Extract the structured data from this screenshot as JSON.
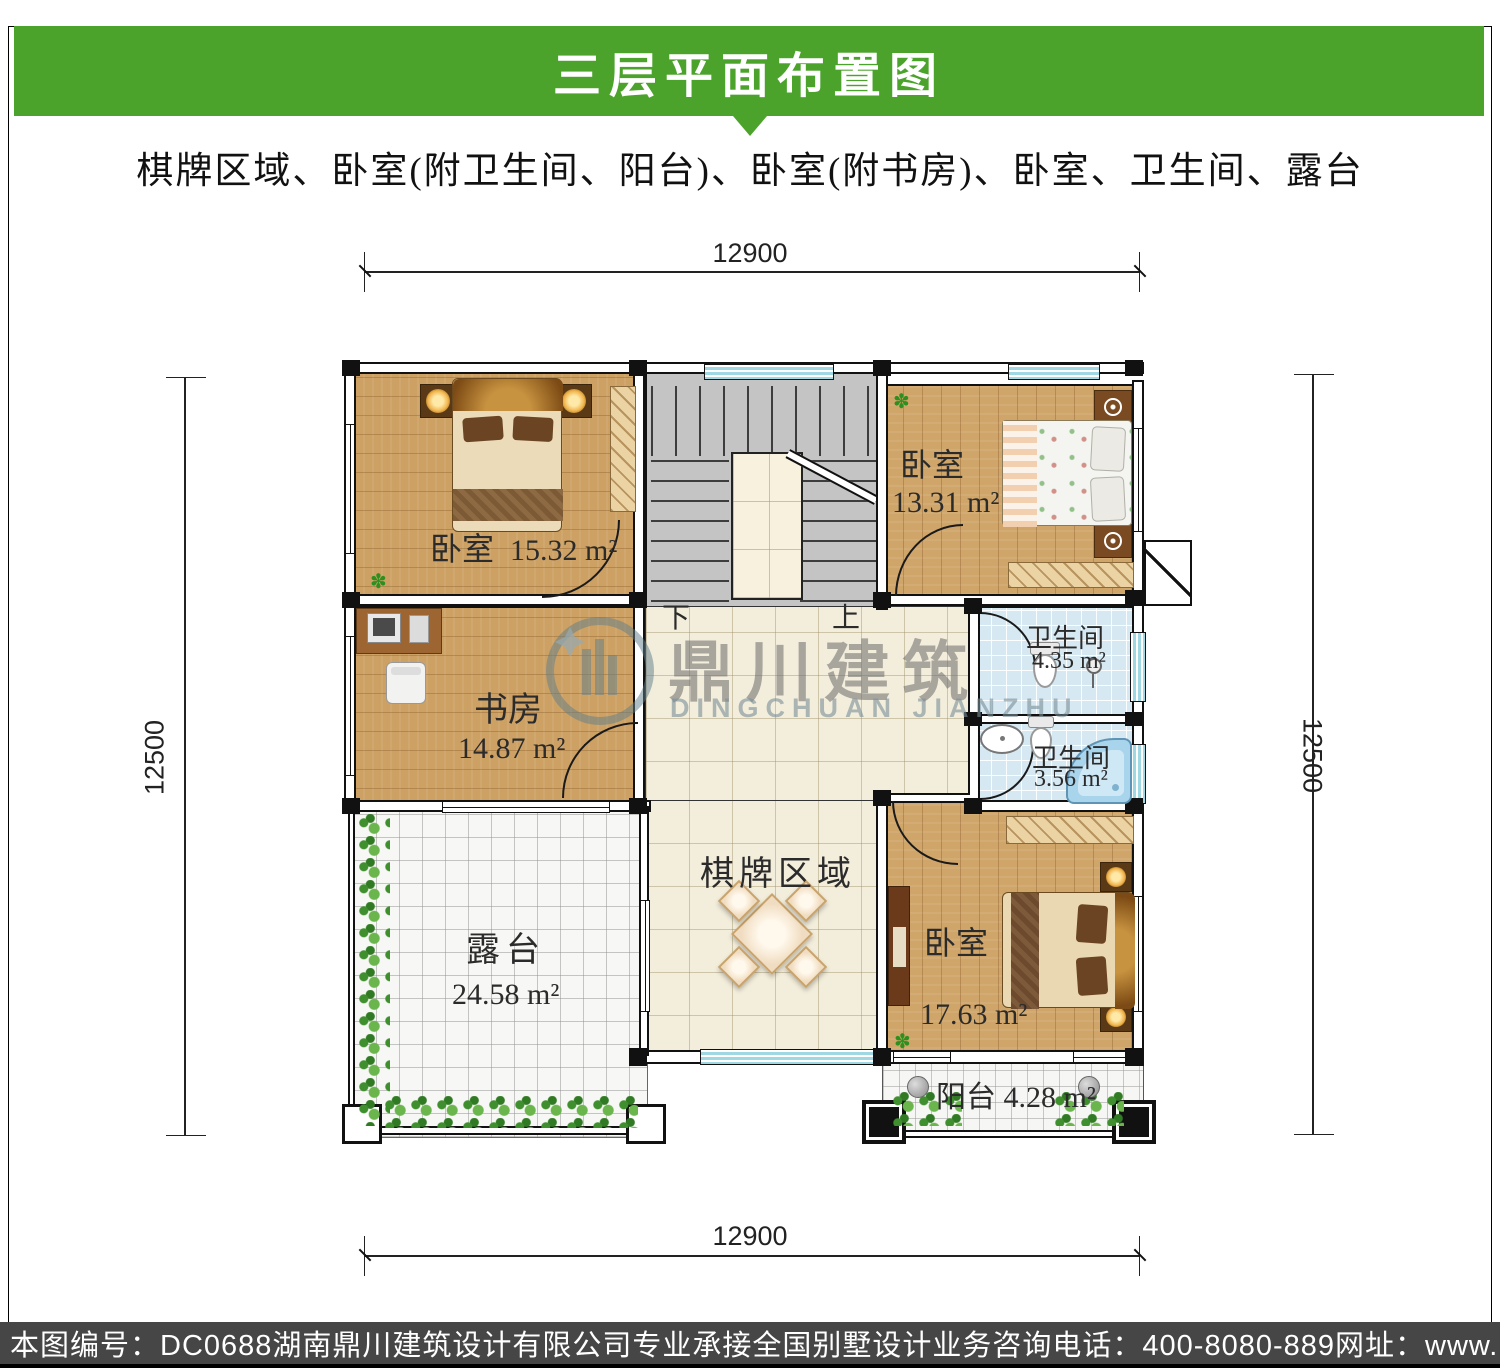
{
  "header": {
    "title": "三层平面布置图",
    "subtitle": "棋牌区域、卧室(附卫生间、阳台)、卧室(附书房)、卧室、卫生间、露台"
  },
  "colors": {
    "banner_green": "#4ba32c",
    "footer_gray": "#464646",
    "bath_tile_blue": "#d6e9f3",
    "wood": "#cda164"
  },
  "dimensions": {
    "top": "12900",
    "bottom": "12900",
    "left": "12500",
    "right": "12500"
  },
  "rooms": {
    "bedroom_tl": {
      "name": "卧室",
      "area": "15.32 m²"
    },
    "bedroom_tr": {
      "name": "卧室",
      "area": "13.31 m²"
    },
    "study": {
      "name": "书房",
      "area": "14.87 m²"
    },
    "bath_upper": {
      "name": "卫生间",
      "area": "4.35 m²"
    },
    "bath_lower": {
      "name": "卫生间",
      "area": "3.56 m²"
    },
    "bedroom_br": {
      "name": "卧室",
      "area": "17.63 m²"
    },
    "chess_area": {
      "name": "棋牌区域"
    },
    "terrace": {
      "name": "露台",
      "area": "24.58 m²"
    },
    "balcony": {
      "name": "阳台",
      "area": "4.28 m²"
    }
  },
  "stairs": {
    "down": "下",
    "up": "上"
  },
  "watermark": {
    "cn": "鼎川建筑",
    "en": "DINGCHUAN JIANZHU"
  },
  "footer": {
    "items": [
      "本图编号：DC0688",
      "湖南鼎川建筑设计有限公司专业承接全国别墅设计业务",
      "咨询电话：400-8080-889",
      "网址：www.bstzcs.com"
    ]
  }
}
